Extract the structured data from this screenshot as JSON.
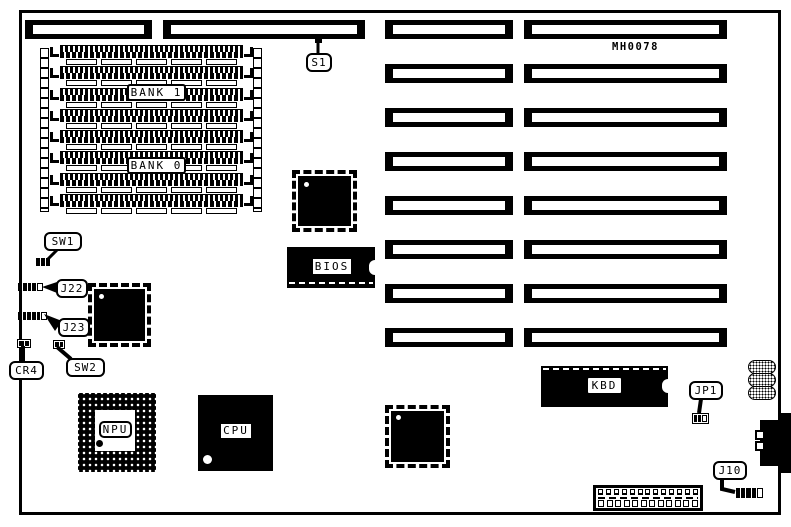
{
  "board": {
    "part_number": "MH0078"
  },
  "labels": {
    "s1": "S1",
    "sw1": "SW1",
    "j22": "J22",
    "j23": "J23",
    "cr4": "CR4",
    "sw2": "SW2",
    "jp1": "JP1",
    "j10": "J10",
    "bank1": "BANK 1",
    "bank0": "BANK 0",
    "npu": "NPU",
    "cpu": "CPU",
    "bios": "BIOS",
    "kbd": "KBD"
  },
  "colors": {
    "ink": "#000000",
    "paper": "#ffffff"
  },
  "slots": {
    "right_rows": 8,
    "top_left_bars": 2
  },
  "memory": {
    "simm_rows": 8,
    "gap_boxes_per_row": 5
  },
  "power_connector": {
    "top_contacts": 13,
    "bottom_contacts": 12
  },
  "connectors": {
    "sw1": {
      "pins": 3
    },
    "j22": {
      "pins": 4
    },
    "j23": {
      "pins": 5
    },
    "cr4": {
      "pins": 2
    },
    "sw2": {
      "pins": 2
    },
    "jp1": {
      "pins": 2
    },
    "j10": {
      "pins": 4
    }
  }
}
